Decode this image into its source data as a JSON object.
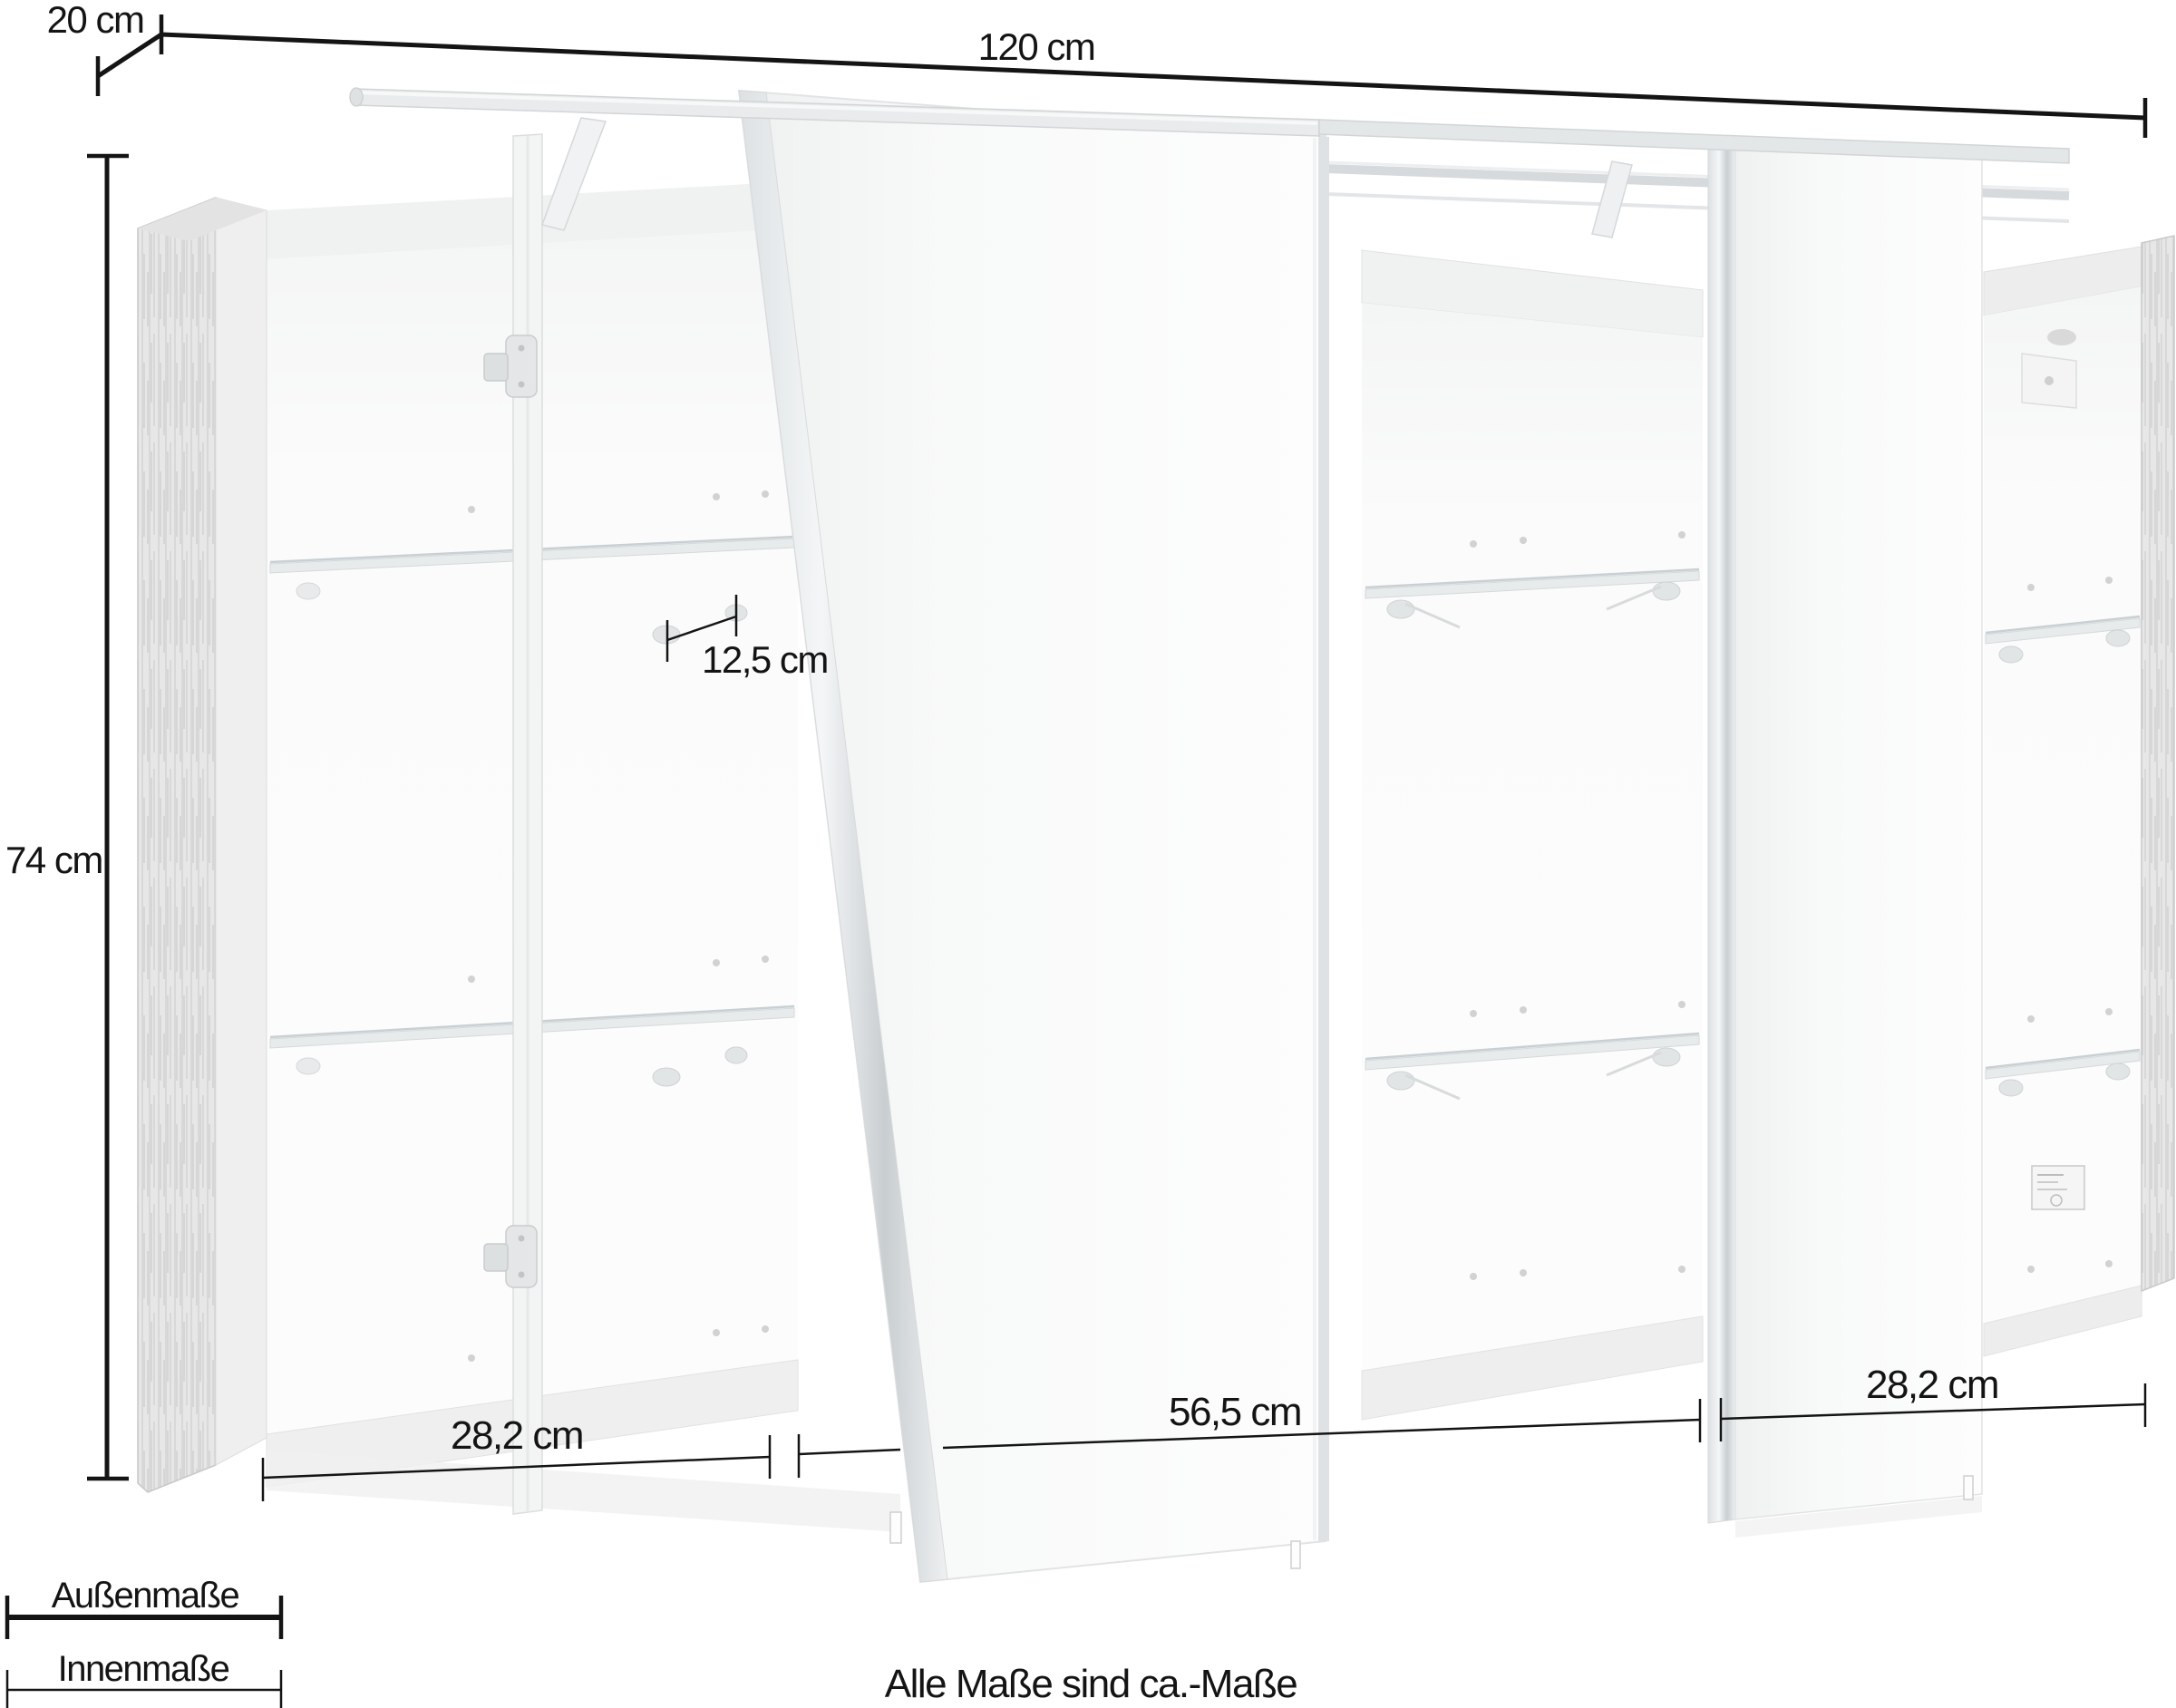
{
  "dimensions": {
    "depth": "20 cm",
    "width": "120 cm",
    "height": "74 cm",
    "shelf_depth": "12,5 cm",
    "section_left": "28,2 cm",
    "section_middle": "56,5 cm",
    "section_right": "28,2 cm"
  },
  "legend": {
    "outer": "Außenmaße",
    "inner": "Innenmaße"
  },
  "footnote": "Alle Maße sind ca.-Maße",
  "colors": {
    "dimension_line": "#141414",
    "wood": "#e7e7e7",
    "chrome": "#d7dbdd",
    "background": "#ffffff"
  }
}
